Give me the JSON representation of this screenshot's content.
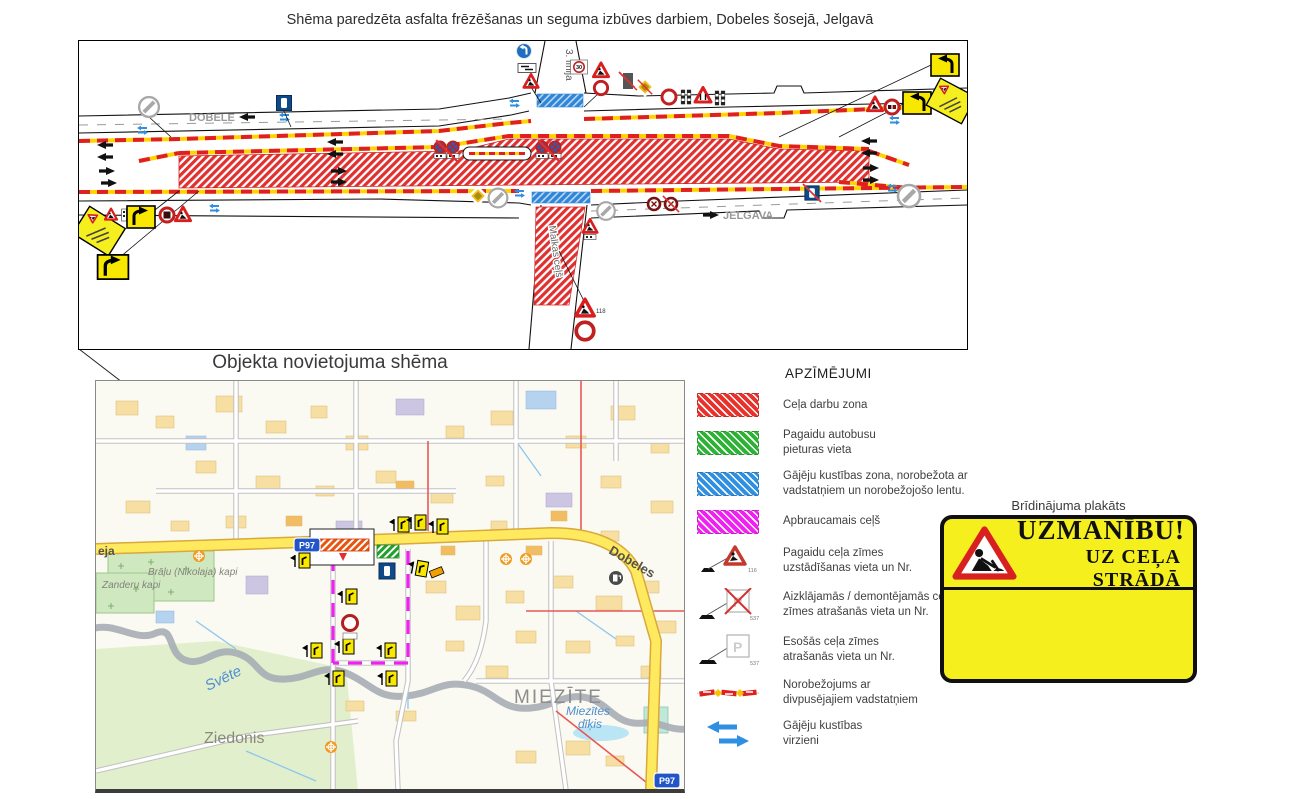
{
  "page": {
    "title": "Shēma paredzēta asfalta frēzēšanas un seguma izbūves darbiem, Dobeles šosejā, Jelgavā"
  },
  "scheme": {
    "direction_left": "DOBELE",
    "direction_right": "JELGAVA",
    "street_top": "3. līnija",
    "street_bottom": "Malkas ceļš",
    "speed_limit": "30",
    "sign_number_118": "118"
  },
  "map": {
    "title": "Objekta novietojuma shēma",
    "labels": {
      "cemetery1": "Brāļu (Nikolaja) kapi",
      "cemetery2": "Zanderu kapi",
      "river": "Svēte",
      "district_sw": "Ziedonis",
      "district_e": "MIEZĪTE",
      "pond_line1": "Miezītes",
      "pond_line2": "dīķis",
      "road": "Dobeles",
      "road_partial": "eja",
      "route_shield": "P97",
      "route_shield_corner": "P97"
    }
  },
  "legend": {
    "title": "APZĪMĒJUMI",
    "zones": [
      {
        "label": "Ceļa darbu zona",
        "color": "#e8312a"
      },
      {
        "label": "Pagaidu autobusu\npieturas vieta",
        "color": "#2eb135"
      },
      {
        "label": "Gājēju kustības zona, norobežota ar\nvadstatņiem un norobežojošo lentu.",
        "color": "#2f8fe0"
      },
      {
        "label": "Apbraucamais ceļš",
        "color": "#f21ff2"
      }
    ],
    "symbols": [
      {
        "label": "Pagaidu ceļa zīmes\nuzstādīšanas vieta un Nr.",
        "number": "116"
      },
      {
        "label": "Aizklājamās / demontējamās ceļa\nzīmes atrašanās vieta un Nr.",
        "number": "537"
      },
      {
        "label": "Esošās ceļa zīmes\natrašanās vieta un Nr.",
        "number": "537"
      },
      {
        "label": "Norobežojums ar\ndivpusējajiem vadstatņiem",
        "number": ""
      },
      {
        "label": "Gājēju kustības\nvirzieni",
        "number": ""
      }
    ]
  },
  "poster": {
    "title": "Brīdinājuma plakāts",
    "line1": "UZMANĪBU!",
    "line2": "UZ CEĻA STRĀDĀ"
  },
  "colors": {
    "work_zone": "#e8312a",
    "temporary_bus_stop": "#2eb135",
    "pedestrian_zone": "#2f8fe0",
    "detour_route": "#f21ff2",
    "poster_background": "#f4ef1d",
    "temporary_sign_yellow": "#f8e800"
  }
}
